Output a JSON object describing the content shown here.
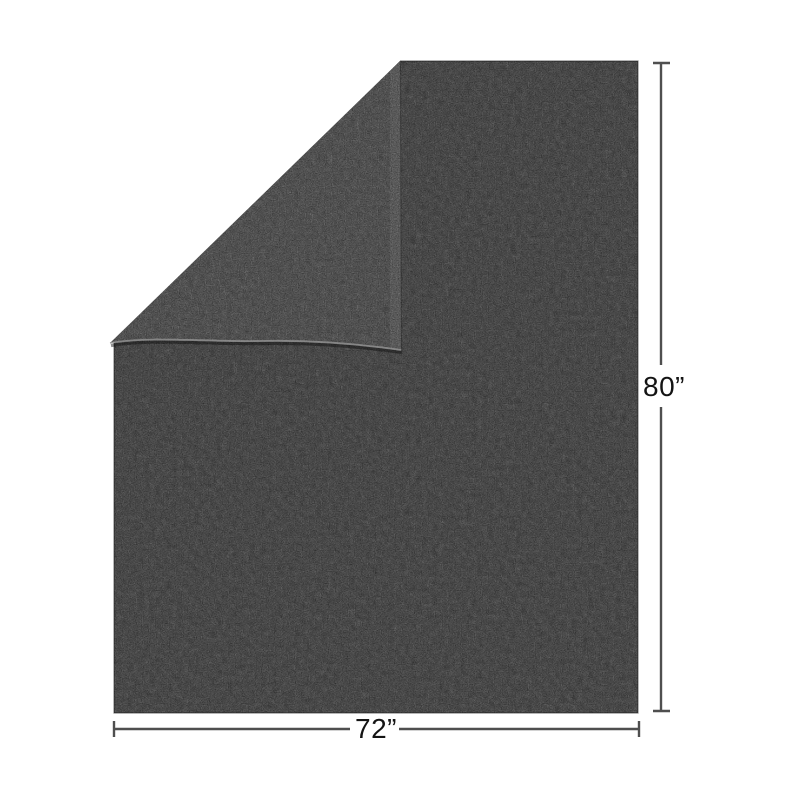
{
  "annotations": {
    "width_label": "72”",
    "height_label": "80”",
    "line_color": "#4f4f4f",
    "label_color": "#141414"
  },
  "product": {
    "background_color": "#ffffff",
    "base_color": "#343434",
    "fold_color": "#3a3a3a",
    "fold_highlight_color": "#9a9a9a",
    "fold_shadow_color": "#0c0c0c",
    "edge_color": "#141414"
  }
}
